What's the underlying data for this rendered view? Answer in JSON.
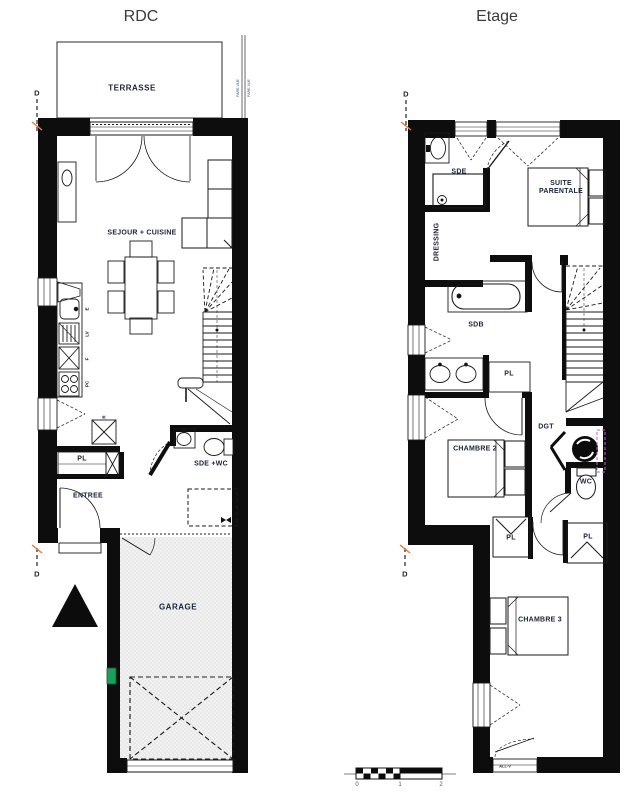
{
  "sheet": {
    "rdc": {
      "title": "RDC",
      "labels": {
        "terrasse": "TERRASSE",
        "pare_vue_a": "PARE-VUE",
        "pare_vue_b": "PARE-VUE",
        "sejour_cuisine": "SEJOUR + CUISINE",
        "pl": "PL",
        "entree": "ENTREE",
        "sde_wc": "SDE +WC",
        "garage": "GARAGE",
        "section_top": "D",
        "section_bottom": "D"
      },
      "appliances": {
        "evier": "E",
        "lave_vaisselle": "LV",
        "four": "F",
        "plaque_cuisson": "PC",
        "refrigerateur": "R"
      }
    },
    "etage": {
      "title": "Etage",
      "labels": {
        "sde": "SDE",
        "suite_parentale": "SUITE PARENTALE",
        "dressing": "DRESSING",
        "sdb": "SDB",
        "pl_sdb": "PL",
        "dgt": "DGT",
        "chambre_2": "CHAMBRE 2",
        "wc": "WC",
        "pl_chambre_2": "PL",
        "pl_chambre_3": "PL",
        "chambre_3": "CHAMBRE 3",
        "all_v": "ALL-V",
        "section_top": "D",
        "section_bottom": "D"
      }
    },
    "scale_bar": {
      "tick_0": "0",
      "tick_1": "1",
      "tick_2": "2"
    },
    "colors": {
      "wall": "#0d0d0d",
      "label_text": "#1a2238",
      "title_text": "#3b3b3b",
      "garage_floor": "#f1f1f1",
      "accent_green": "#1aa05b",
      "accent_purple": "#b46bc8",
      "accent_orange": "#e07b39"
    }
  }
}
